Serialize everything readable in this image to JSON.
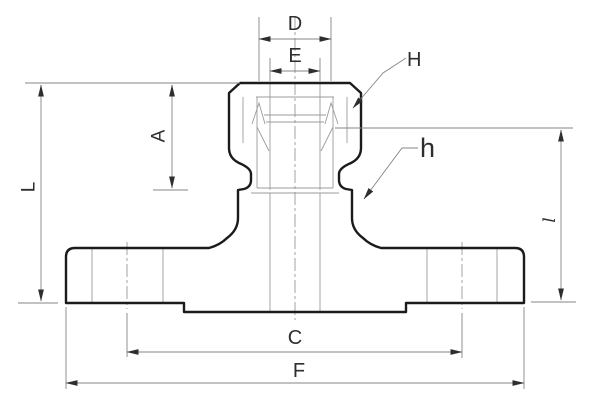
{
  "page": {
    "background": "#ffffff",
    "width": 600,
    "height": 406
  },
  "diagram": {
    "kind": "engineering-cross-section-drawing",
    "subject": "flanged compression tube fitting, sectional view with dimension callouts",
    "labels": {
      "D": "D",
      "E": "E",
      "H": "H",
      "A": "A",
      "L": "L",
      "h": "h",
      "l": "l",
      "C": "C",
      "F": "F"
    },
    "colors": {
      "outline": "#1b1b1b",
      "internal_lines": "#9b9b9b",
      "dimension_lines": "#858585",
      "centerline": "#9a9a9a",
      "label_text": "#2e2e2e",
      "background": "#ffffff"
    }
  }
}
